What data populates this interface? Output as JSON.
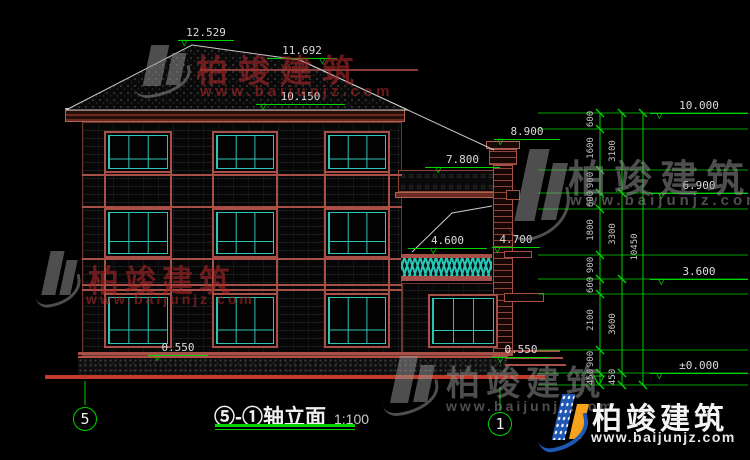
{
  "title": {
    "name": "⑤-①轴立面",
    "scale": "1:100"
  },
  "axes": {
    "left": "5",
    "right": "1"
  },
  "elevations": {
    "ridge_main": "12.529",
    "ridge_rear": "11.692",
    "eave": "10.150",
    "chimney_top": "8.900",
    "porch_roof": "7.800",
    "balcony": "4.600",
    "balcony_door": "4.700",
    "plinth_left": "0.550",
    "plinth_right": "0.550",
    "level_top": "10.000",
    "level_3f": "6.900",
    "level_2f": "3.600",
    "level_gf": "±0.000"
  },
  "dims": {
    "inner": [
      "600",
      "1600",
      "900",
      "600",
      "1800",
      "900",
      "600",
      "2100",
      "900",
      "450"
    ],
    "middle": [
      "3100",
      "3300",
      "3600",
      "450"
    ],
    "overall": "10450"
  },
  "watermark": {
    "brand": "柏竣建筑",
    "site": "www.baijunjz.com"
  },
  "logo": {
    "brand": "柏竣建筑",
    "site": "www.baijunjz.com"
  },
  "colors": {
    "dimension_green": "#00d400",
    "line_red": "#a85048",
    "ground_red": "#c23b28",
    "mullion_teal": "#2fc4b4",
    "watermark_red": "rgba(170,40,40,0.62)",
    "watermark_grey": "rgba(150,150,150,0.52)",
    "logo_blue": "#1f57b5",
    "logo_orange": "#f6a21c"
  }
}
